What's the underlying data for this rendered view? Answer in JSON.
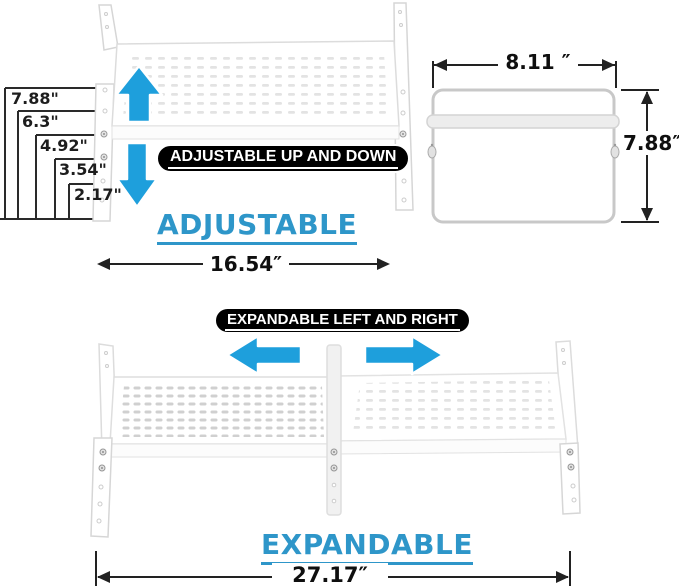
{
  "colors": {
    "accent_blue": "#2E96C9",
    "arrow_blue": "#1E9FDC",
    "callout_bg": "#000000",
    "callout_text": "#FFFFFF",
    "dimension_line": "#222222"
  },
  "top_section": {
    "height_labels": [
      "7.88\"",
      "6.3\"",
      "4.92\"",
      "3.54\"",
      "2.17\""
    ],
    "callout": "ADJUSTABLE UP AND DOWN",
    "title": "ADJUSTABLE",
    "width_dimension": "16.54″"
  },
  "side_view": {
    "width_dimension": "8.11 ″",
    "height_dimension": "7.88″"
  },
  "bottom_section": {
    "callout": "EXPANDABLE LEFT AND RIGHT",
    "title": "EXPANDABLE",
    "width_dimension": "27.17″"
  },
  "icons": {
    "top_arrows": [
      "up-arrow",
      "down-arrow"
    ],
    "bottom_arrows": [
      "left-arrow",
      "right-arrow"
    ]
  }
}
